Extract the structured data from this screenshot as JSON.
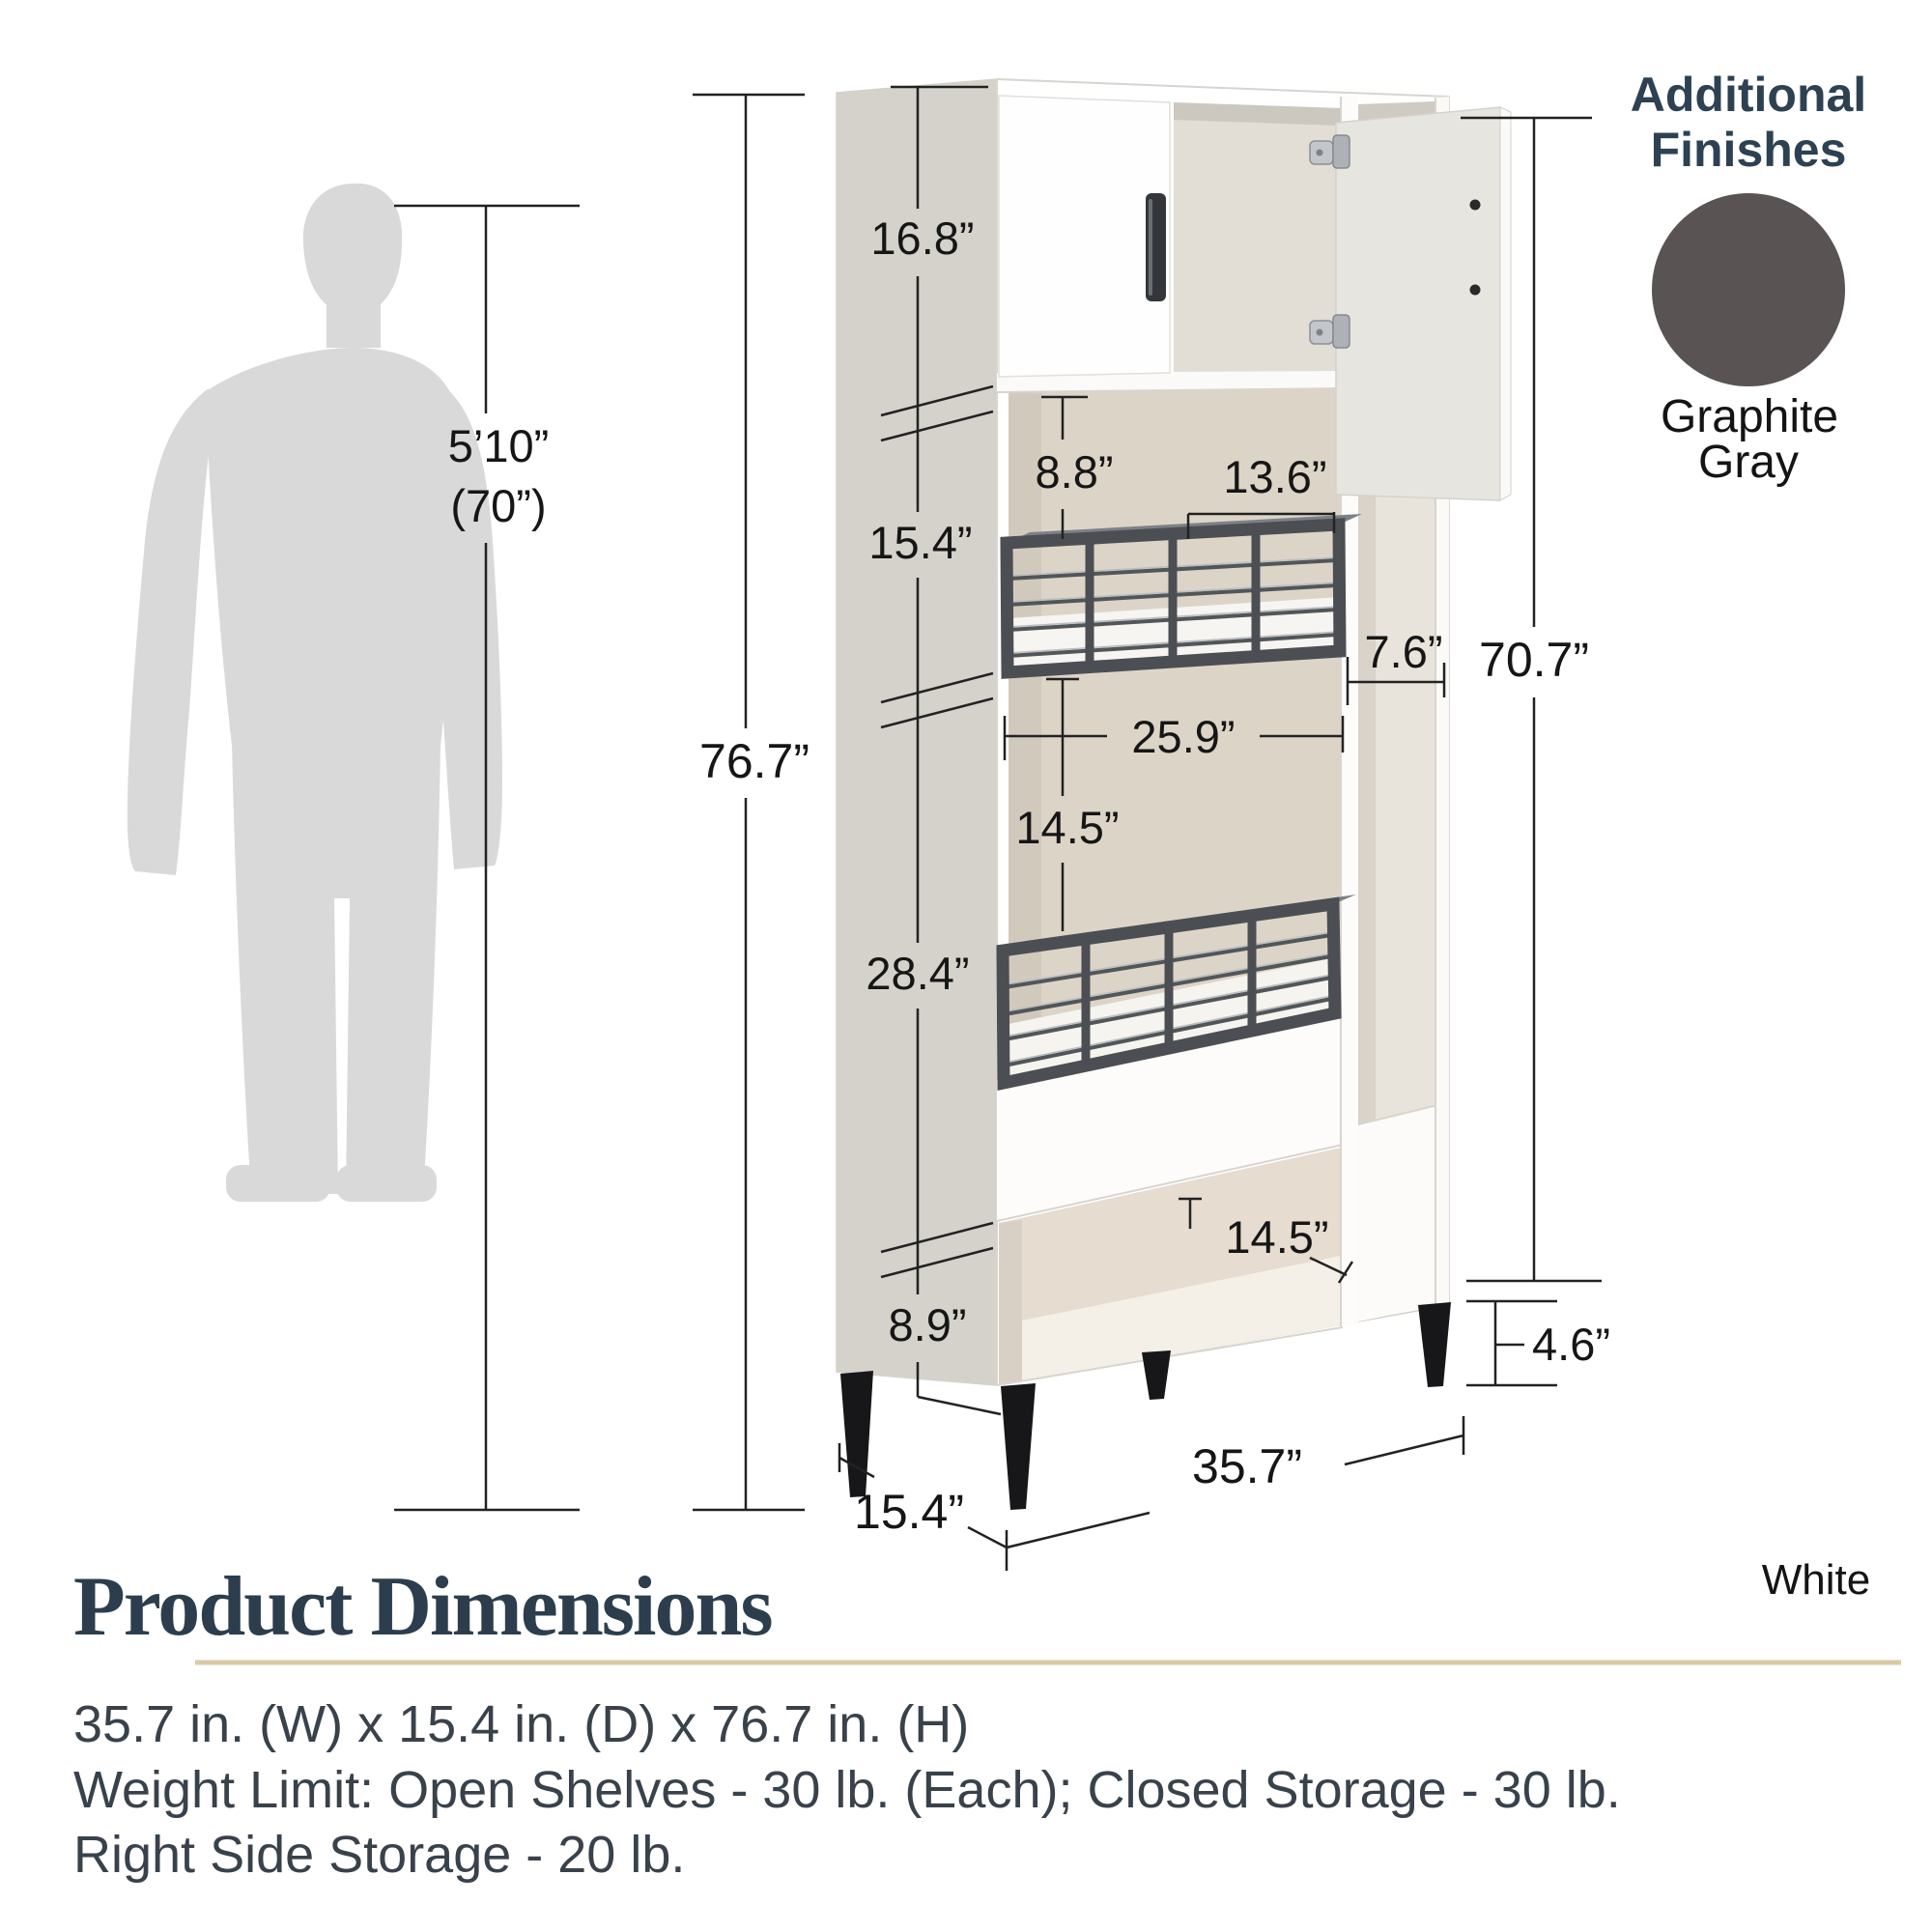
{
  "person": {
    "height_label": "5’10”",
    "height_alt_label": "(70”)"
  },
  "cabinet_dims": {
    "overall_height": "76.7”",
    "top_cabinet_height": "16.8”",
    "upper_shelf_section": "15.4”",
    "middle_section": "28.4”",
    "bottom_section": "8.9”",
    "shelf_clearance": "8.8”",
    "upper_shelf_width": "13.6”",
    "interior_width": "25.9”",
    "between_baskets": "14.5”",
    "cubby_depth": "14.5”",
    "side_storage_width": "7.6”",
    "side_storage_height": "70.7”",
    "leg_height": "4.6”",
    "overall_width": "35.7”",
    "overall_depth": "15.4”"
  },
  "finishes": {
    "heading_line1": "Additional",
    "heading_line2": "Finishes",
    "swatch_color": "#595354",
    "swatch_name_line1": "Graphite",
    "swatch_name_line2": "Gray",
    "current_finish_label": "White"
  },
  "details": {
    "title": "Product Dimensions",
    "accent_color": "#d9caa4",
    "dimensions_line": "35.7 in. (W) x 15.4 in. (D) x 76.7 in. (H)",
    "weight_line": "Weight Limit: Open Shelves - 30 lb. (Each); Closed Storage - 30 lb.",
    "right_side_line": "Right Side Storage - 20 lb."
  }
}
